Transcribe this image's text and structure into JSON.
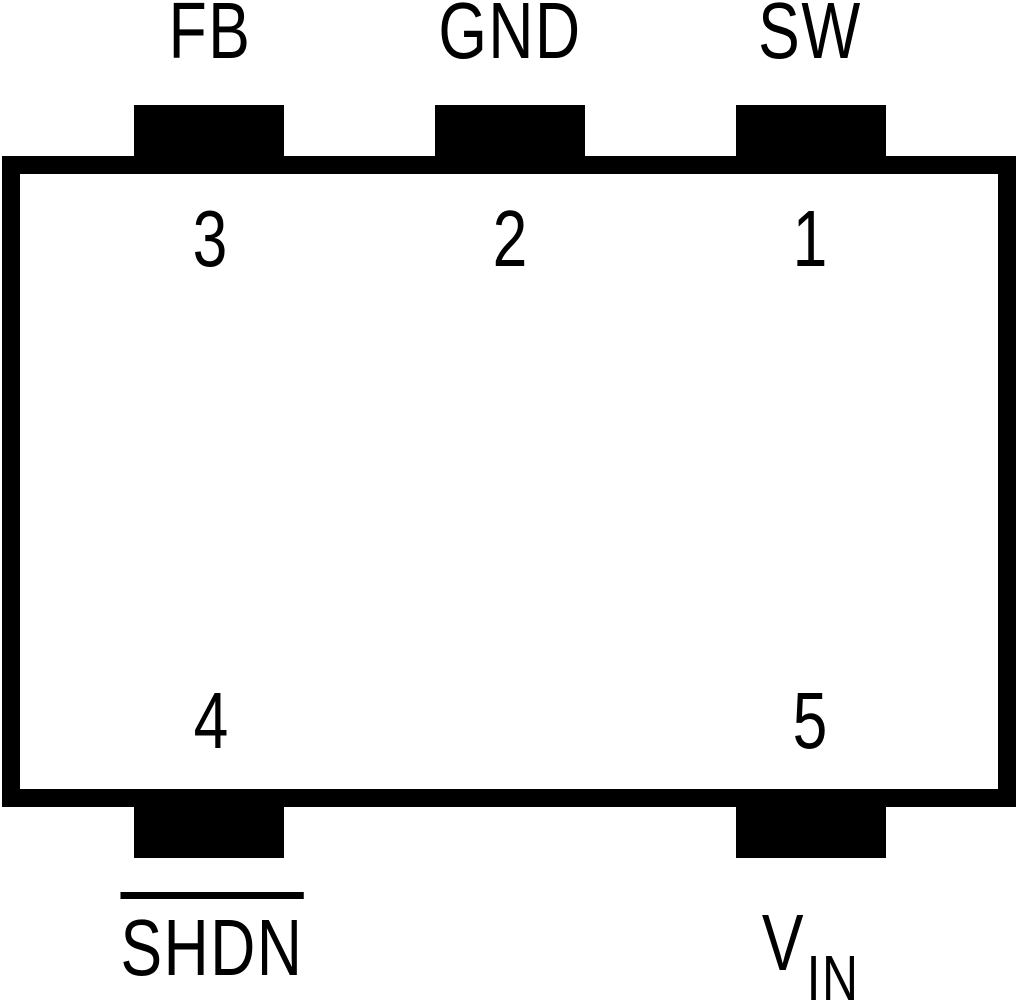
{
  "pinout": {
    "colors": {
      "ink": "#000000",
      "background": "#ffffff"
    },
    "pins": [
      {
        "number": "1",
        "label": "SW",
        "side": "top"
      },
      {
        "number": "2",
        "label": "GND",
        "side": "top"
      },
      {
        "number": "3",
        "label": "FB",
        "side": "top"
      },
      {
        "number": "4",
        "label": "SHDN",
        "overline": true,
        "side": "bottom"
      },
      {
        "number": "5",
        "label": "V",
        "label_subscript": "IN",
        "side": "bottom"
      }
    ]
  }
}
